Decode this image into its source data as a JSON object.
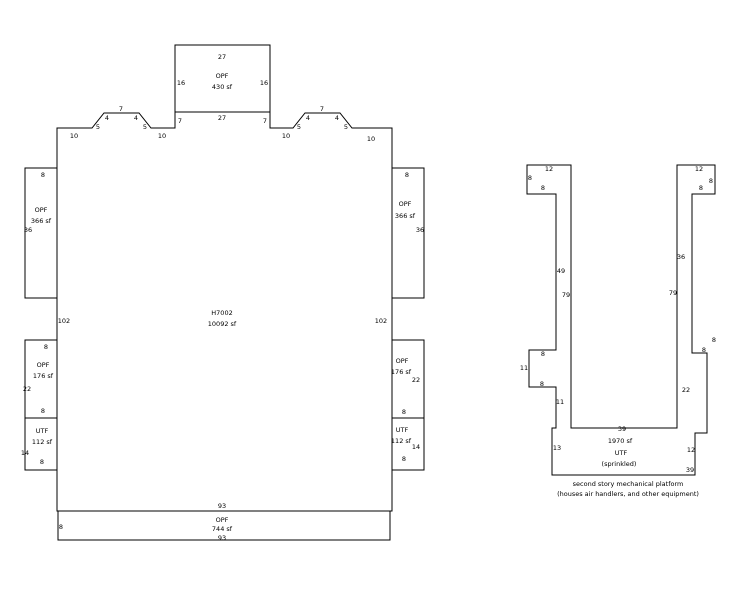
{
  "diagram": {
    "line_color": "#000000",
    "text_color": "#000000",
    "background": "#ffffff",
    "main_building": {
      "id": "H7002",
      "area": "10092 sf"
    },
    "platform": {
      "name": "UTF",
      "note": "(sprinkled)",
      "area": "1970 sf"
    },
    "labels": {
      "roof_opf": [
        {
          "t": "27",
          "x": 222,
          "y": 57,
          "k": "dim"
        },
        {
          "t": "16",
          "x": 181,
          "y": 83,
          "k": "dim"
        },
        {
          "t": "16",
          "x": 264,
          "y": 83,
          "k": "dim"
        },
        {
          "t": "OPF",
          "x": 222,
          "y": 76,
          "k": "room"
        },
        {
          "t": "430 sf",
          "x": 222,
          "y": 87,
          "k": "area"
        },
        {
          "t": "27",
          "x": 222,
          "y": 118,
          "k": "dim"
        }
      ],
      "main_top_edge": [
        {
          "t": "10",
          "x": 74,
          "y": 136,
          "k": "dim"
        },
        {
          "t": "5",
          "x": 98,
          "y": 127,
          "k": "dim"
        },
        {
          "t": "4",
          "x": 107,
          "y": 118,
          "k": "dim"
        },
        {
          "t": "7",
          "x": 121,
          "y": 109,
          "k": "dim"
        },
        {
          "t": "4",
          "x": 136,
          "y": 118,
          "k": "dim"
        },
        {
          "t": "5",
          "x": 145,
          "y": 127,
          "k": "dim"
        },
        {
          "t": "10",
          "x": 162,
          "y": 136,
          "k": "dim"
        },
        {
          "t": "7",
          "x": 180,
          "y": 121,
          "k": "dim"
        },
        {
          "t": "7",
          "x": 265,
          "y": 121,
          "k": "dim"
        },
        {
          "t": "10",
          "x": 286,
          "y": 136,
          "k": "dim"
        },
        {
          "t": "5",
          "x": 299,
          "y": 127,
          "k": "dim"
        },
        {
          "t": "4",
          "x": 308,
          "y": 118,
          "k": "dim"
        },
        {
          "t": "7",
          "x": 322,
          "y": 109,
          "k": "dim"
        },
        {
          "t": "4",
          "x": 337,
          "y": 118,
          "k": "dim"
        },
        {
          "t": "5",
          "x": 346,
          "y": 127,
          "k": "dim"
        },
        {
          "t": "10",
          "x": 371,
          "y": 139,
          "k": "dim"
        }
      ],
      "main_center": [
        {
          "t": "H7002",
          "x": 222,
          "y": 313,
          "k": "id"
        },
        {
          "t": "10092 sf",
          "x": 222,
          "y": 324,
          "k": "area"
        },
        {
          "t": "102",
          "x": 64,
          "y": 321,
          "k": "dim"
        },
        {
          "t": "102",
          "x": 381,
          "y": 321,
          "k": "dim"
        }
      ],
      "bottom_opf": [
        {
          "t": "93",
          "x": 222,
          "y": 506,
          "k": "dim"
        },
        {
          "t": "8",
          "x": 61,
          "y": 527,
          "k": "dim"
        },
        {
          "t": "OPF",
          "x": 222,
          "y": 520,
          "k": "room"
        },
        {
          "t": "744 sf",
          "x": 222,
          "y": 529,
          "k": "area"
        },
        {
          "t": "93",
          "x": 222,
          "y": 538,
          "k": "dim"
        }
      ],
      "west_wing_upper": [
        {
          "t": "8",
          "x": 43,
          "y": 175,
          "k": "dim"
        },
        {
          "t": "OPF",
          "x": 41,
          "y": 210,
          "k": "room"
        },
        {
          "t": "366 sf",
          "x": 41,
          "y": 221,
          "k": "area"
        },
        {
          "t": "36",
          "x": 28,
          "y": 230,
          "k": "dim"
        }
      ],
      "west_wing_mid": [
        {
          "t": "8",
          "x": 46,
          "y": 347,
          "k": "dim"
        },
        {
          "t": "OPF",
          "x": 43,
          "y": 365,
          "k": "room"
        },
        {
          "t": "176 sf",
          "x": 43,
          "y": 376,
          "k": "area"
        },
        {
          "t": "22",
          "x": 27,
          "y": 389,
          "k": "dim"
        },
        {
          "t": "8",
          "x": 43,
          "y": 411,
          "k": "dim"
        }
      ],
      "west_wing_lower": [
        {
          "t": "UTF",
          "x": 42,
          "y": 431,
          "k": "room"
        },
        {
          "t": "112 sf",
          "x": 42,
          "y": 442,
          "k": "area"
        },
        {
          "t": "14",
          "x": 25,
          "y": 453,
          "k": "dim"
        },
        {
          "t": "8",
          "x": 42,
          "y": 462,
          "k": "dim"
        }
      ],
      "east_wing_upper": [
        {
          "t": "8",
          "x": 407,
          "y": 175,
          "k": "dim"
        },
        {
          "t": "OPF",
          "x": 405,
          "y": 204,
          "k": "room"
        },
        {
          "t": "366 sf",
          "x": 405,
          "y": 216,
          "k": "area"
        },
        {
          "t": "36",
          "x": 420,
          "y": 230,
          "k": "dim"
        }
      ],
      "east_wing_mid": [
        {
          "t": "OPF",
          "x": 402,
          "y": 361,
          "k": "room"
        },
        {
          "t": "176 sf",
          "x": 401,
          "y": 372,
          "k": "area"
        },
        {
          "t": "22",
          "x": 416,
          "y": 380,
          "k": "dim"
        },
        {
          "t": "8",
          "x": 404,
          "y": 412,
          "k": "dim"
        }
      ],
      "east_wing_lower": [
        {
          "t": "UTF",
          "x": 402,
          "y": 430,
          "k": "room"
        },
        {
          "t": "112 sf",
          "x": 401,
          "y": 441,
          "k": "area"
        },
        {
          "t": "14",
          "x": 416,
          "y": 447,
          "k": "dim"
        },
        {
          "t": "8",
          "x": 404,
          "y": 459,
          "k": "dim"
        }
      ],
      "platform_left_arm": [
        {
          "t": "12",
          "x": 549,
          "y": 169,
          "k": "dim"
        },
        {
          "t": "8",
          "x": 530,
          "y": 178,
          "k": "dim"
        },
        {
          "t": "8",
          "x": 543,
          "y": 188,
          "k": "dim"
        },
        {
          "t": "49",
          "x": 561,
          "y": 271,
          "k": "dim"
        },
        {
          "t": "79",
          "x": 566,
          "y": 295,
          "k": "dim"
        },
        {
          "t": "8",
          "x": 543,
          "y": 354,
          "k": "dim"
        },
        {
          "t": "11",
          "x": 524,
          "y": 368,
          "k": "dim"
        },
        {
          "t": "8",
          "x": 542,
          "y": 384,
          "k": "dim"
        },
        {
          "t": "11",
          "x": 560,
          "y": 402,
          "k": "dim"
        }
      ],
      "platform_right_arm": [
        {
          "t": "12",
          "x": 699,
          "y": 169,
          "k": "dim"
        },
        {
          "t": "8",
          "x": 711,
          "y": 181,
          "k": "dim"
        },
        {
          "t": "8",
          "x": 701,
          "y": 188,
          "k": "dim"
        },
        {
          "t": "36",
          "x": 681,
          "y": 257,
          "k": "dim"
        },
        {
          "t": "79",
          "x": 673,
          "y": 293,
          "k": "dim"
        },
        {
          "t": "8",
          "x": 714,
          "y": 340,
          "k": "dim"
        },
        {
          "t": "8",
          "x": 704,
          "y": 350,
          "k": "dim"
        },
        {
          "t": "22",
          "x": 686,
          "y": 390,
          "k": "dim"
        }
      ],
      "platform_base": [
        {
          "t": "39",
          "x": 622,
          "y": 429,
          "k": "dim"
        },
        {
          "t": "1970 sf",
          "x": 620,
          "y": 441,
          "k": "area"
        },
        {
          "t": "UTF",
          "x": 621,
          "y": 453,
          "k": "room"
        },
        {
          "t": "(sprinkled)",
          "x": 619,
          "y": 464,
          "k": "note"
        },
        {
          "t": "13",
          "x": 557,
          "y": 448,
          "k": "dim"
        },
        {
          "t": "12",
          "x": 691,
          "y": 450,
          "k": "dim"
        },
        {
          "t": "39",
          "x": 690,
          "y": 470,
          "k": "dim"
        }
      ]
    },
    "captions": [
      {
        "t": "second story mechanical platform",
        "x": 628,
        "y": 484
      },
      {
        "t": "(houses air handlers, and other equipment)",
        "x": 628,
        "y": 494
      }
    ]
  }
}
